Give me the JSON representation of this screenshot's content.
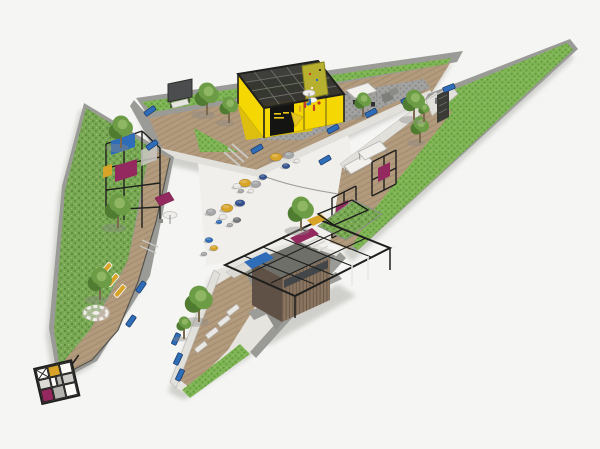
{
  "palette": {
    "bg": "#f5f5f3",
    "plazaTint": "#f0efec",
    "lawn": "#79a854",
    "lawnDot": "#5c8a3c",
    "lawnLight": "#98c06e",
    "hedge": "#7fb554",
    "hedgeDot": "#5f9a3c",
    "wallLight": "#e2e0db",
    "wallGray": "#9a9a96",
    "wallDark": "#6e6e6a",
    "deck": "#b29a7d",
    "deckLine": "#8f7a5e",
    "cobble": "#a3a3a1",
    "cobbleDot": "#8b8b89",
    "paveDark": "#8f8f8b",
    "pavYellow": "#f4d703",
    "pavYellowDeep": "#e2c303",
    "frameBlack": "#1f1f1d",
    "signBlack": "#141412",
    "signText": "#e8c817",
    "climbOlive": "#b7b02f",
    "canopyWhite": "#f1f0ed",
    "magenta": "#93295f",
    "blue": "#2f6db8",
    "navy": "#33518e",
    "mustard": "#d8a427",
    "poufGray": "#a6a7a9",
    "poufDark": "#72757a",
    "poufWhite": "#e9e8e4",
    "red": "#c03a2b",
    "woodA": "#8a7560",
    "woodB": "#6b5948",
    "woodDark": "#5f5145",
    "glass": "#43474a",
    "treeGreen": "#6d9c46",
    "treeLight": "#8fb662",
    "treeDark": "#4f7c31",
    "trunk": "#7c6a50",
    "railing": "#55554f",
    "shadow": "#8a8a85"
  },
  "scene": {
    "trees": [
      {
        "x": 207,
        "y": 95,
        "s": 13
      },
      {
        "x": 229,
        "y": 106,
        "s": 10
      },
      {
        "x": 363,
        "y": 101,
        "s": 9
      },
      {
        "x": 414,
        "y": 101,
        "s": 12
      },
      {
        "x": 121,
        "y": 128,
        "s": 13
      },
      {
        "x": 118,
        "y": 207,
        "s": 14
      },
      {
        "x": 100,
        "y": 280,
        "s": 13
      },
      {
        "x": 420,
        "y": 126,
        "s": 10
      },
      {
        "x": 424,
        "y": 109,
        "s": 6
      },
      {
        "x": 199,
        "y": 300,
        "s": 15
      },
      {
        "x": 184,
        "y": 324,
        "s": 8
      },
      {
        "x": 301,
        "y": 210,
        "s": 14
      }
    ],
    "poufs": [
      {
        "x": 276,
        "y": 157,
        "r": 6,
        "c": "mustard"
      },
      {
        "x": 289,
        "y": 155,
        "r": 5,
        "c": "poufGray"
      },
      {
        "x": 286,
        "y": 166,
        "r": 4,
        "c": "navy"
      },
      {
        "x": 297,
        "y": 161,
        "r": 3,
        "c": "poufWhite"
      },
      {
        "x": 245,
        "y": 183,
        "r": 6,
        "c": "mustard"
      },
      {
        "x": 237,
        "y": 186,
        "r": 4,
        "c": "poufWhite"
      },
      {
        "x": 256,
        "y": 184,
        "r": 5,
        "c": "poufGray"
      },
      {
        "x": 263,
        "y": 177,
        "r": 4,
        "c": "navy"
      },
      {
        "x": 241,
        "y": 191,
        "r": 3,
        "c": "poufGray"
      },
      {
        "x": 251,
        "y": 191,
        "r": 3,
        "c": "poufWhite"
      },
      {
        "x": 240,
        "y": 203,
        "r": 5,
        "c": "navy"
      },
      {
        "x": 227,
        "y": 208,
        "r": 6,
        "c": "mustard"
      },
      {
        "x": 211,
        "y": 212,
        "r": 5,
        "c": "poufGray"
      },
      {
        "x": 223,
        "y": 217,
        "r": 4,
        "c": "poufWhite"
      },
      {
        "x": 237,
        "y": 220,
        "r": 4,
        "c": "poufDark"
      },
      {
        "x": 219,
        "y": 222,
        "r": 3,
        "c": "blue"
      },
      {
        "x": 230,
        "y": 225,
        "r": 3,
        "c": "poufGray"
      },
      {
        "x": 209,
        "y": 240,
        "r": 4,
        "c": "blue"
      },
      {
        "x": 214,
        "y": 248,
        "r": 4,
        "c": "mustard"
      },
      {
        "x": 204,
        "y": 254,
        "r": 3,
        "c": "poufGray"
      }
    ],
    "blue_benches": [
      {
        "x": 150,
        "y": 111,
        "a": -35
      },
      {
        "x": 152,
        "y": 145,
        "a": -35
      },
      {
        "x": 257,
        "y": 149,
        "a": -30
      },
      {
        "x": 333,
        "y": 129,
        "a": -28
      },
      {
        "x": 371,
        "y": 113,
        "a": -28
      },
      {
        "x": 407,
        "y": 100,
        "a": -24
      },
      {
        "x": 449,
        "y": 88,
        "a": -22
      },
      {
        "x": 325,
        "y": 160,
        "a": -30
      },
      {
        "x": 176,
        "y": 339,
        "a": -65
      },
      {
        "x": 178,
        "y": 359,
        "a": -65
      },
      {
        "x": 180,
        "y": 375,
        "a": -65
      },
      {
        "x": 141,
        "y": 287,
        "a": -55
      },
      {
        "x": 131,
        "y": 321,
        "a": -55
      }
    ],
    "white_loungers": [
      {
        "x": 212,
        "y": 333,
        "a": -38
      },
      {
        "x": 224,
        "y": 321,
        "a": -38
      },
      {
        "x": 201,
        "y": 347,
        "a": -38
      },
      {
        "x": 233,
        "y": 310,
        "a": -38
      }
    ],
    "yellow_loungers": [
      {
        "x": 106,
        "y": 269,
        "a": -50
      },
      {
        "x": 113,
        "y": 280,
        "a": -50
      },
      {
        "x": 120,
        "y": 291,
        "a": -50
      }
    ],
    "figures": [
      {
        "x": 305,
        "y": 107,
        "c": "red"
      },
      {
        "x": 310,
        "y": 104,
        "c": "blue"
      },
      {
        "x": 300,
        "y": 111,
        "c": "mustard"
      },
      {
        "x": 314,
        "y": 110,
        "c": "red"
      },
      {
        "x": 436,
        "y": 103,
        "c": "poufDark"
      }
    ]
  }
}
